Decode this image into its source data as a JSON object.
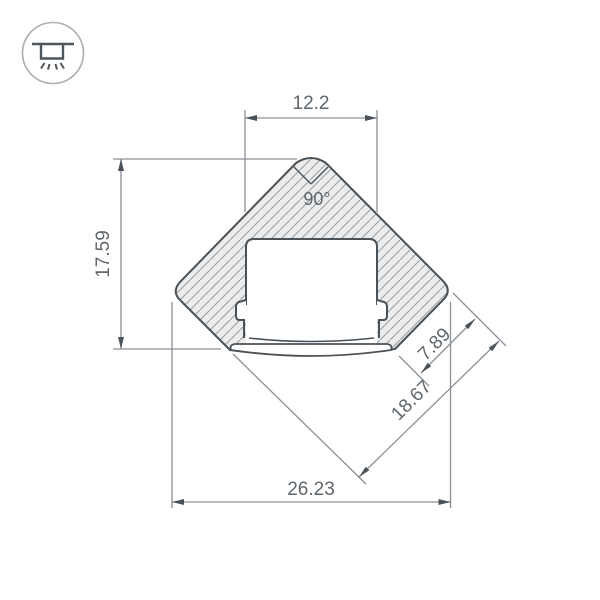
{
  "window": {
    "background": "#ffffff"
  },
  "legend_icon": {
    "name": "ceiling-surface-light"
  },
  "drawing": {
    "angle_label": "90°",
    "dim_top_width": "12.2",
    "dim_left_height": "17.59",
    "dim_face_small": "7.89",
    "dim_face_long": "18.67",
    "dim_bottom_width": "26.23",
    "colors": {
      "outline": "#4a5157",
      "dimension_line": "#8a9096",
      "label_text": "#5f666c",
      "hatch_line": "#98a0a6",
      "body_fill": "#ececec",
      "icon_circle": "#a8aeb3",
      "icon_glyph": "#4e555b"
    }
  }
}
